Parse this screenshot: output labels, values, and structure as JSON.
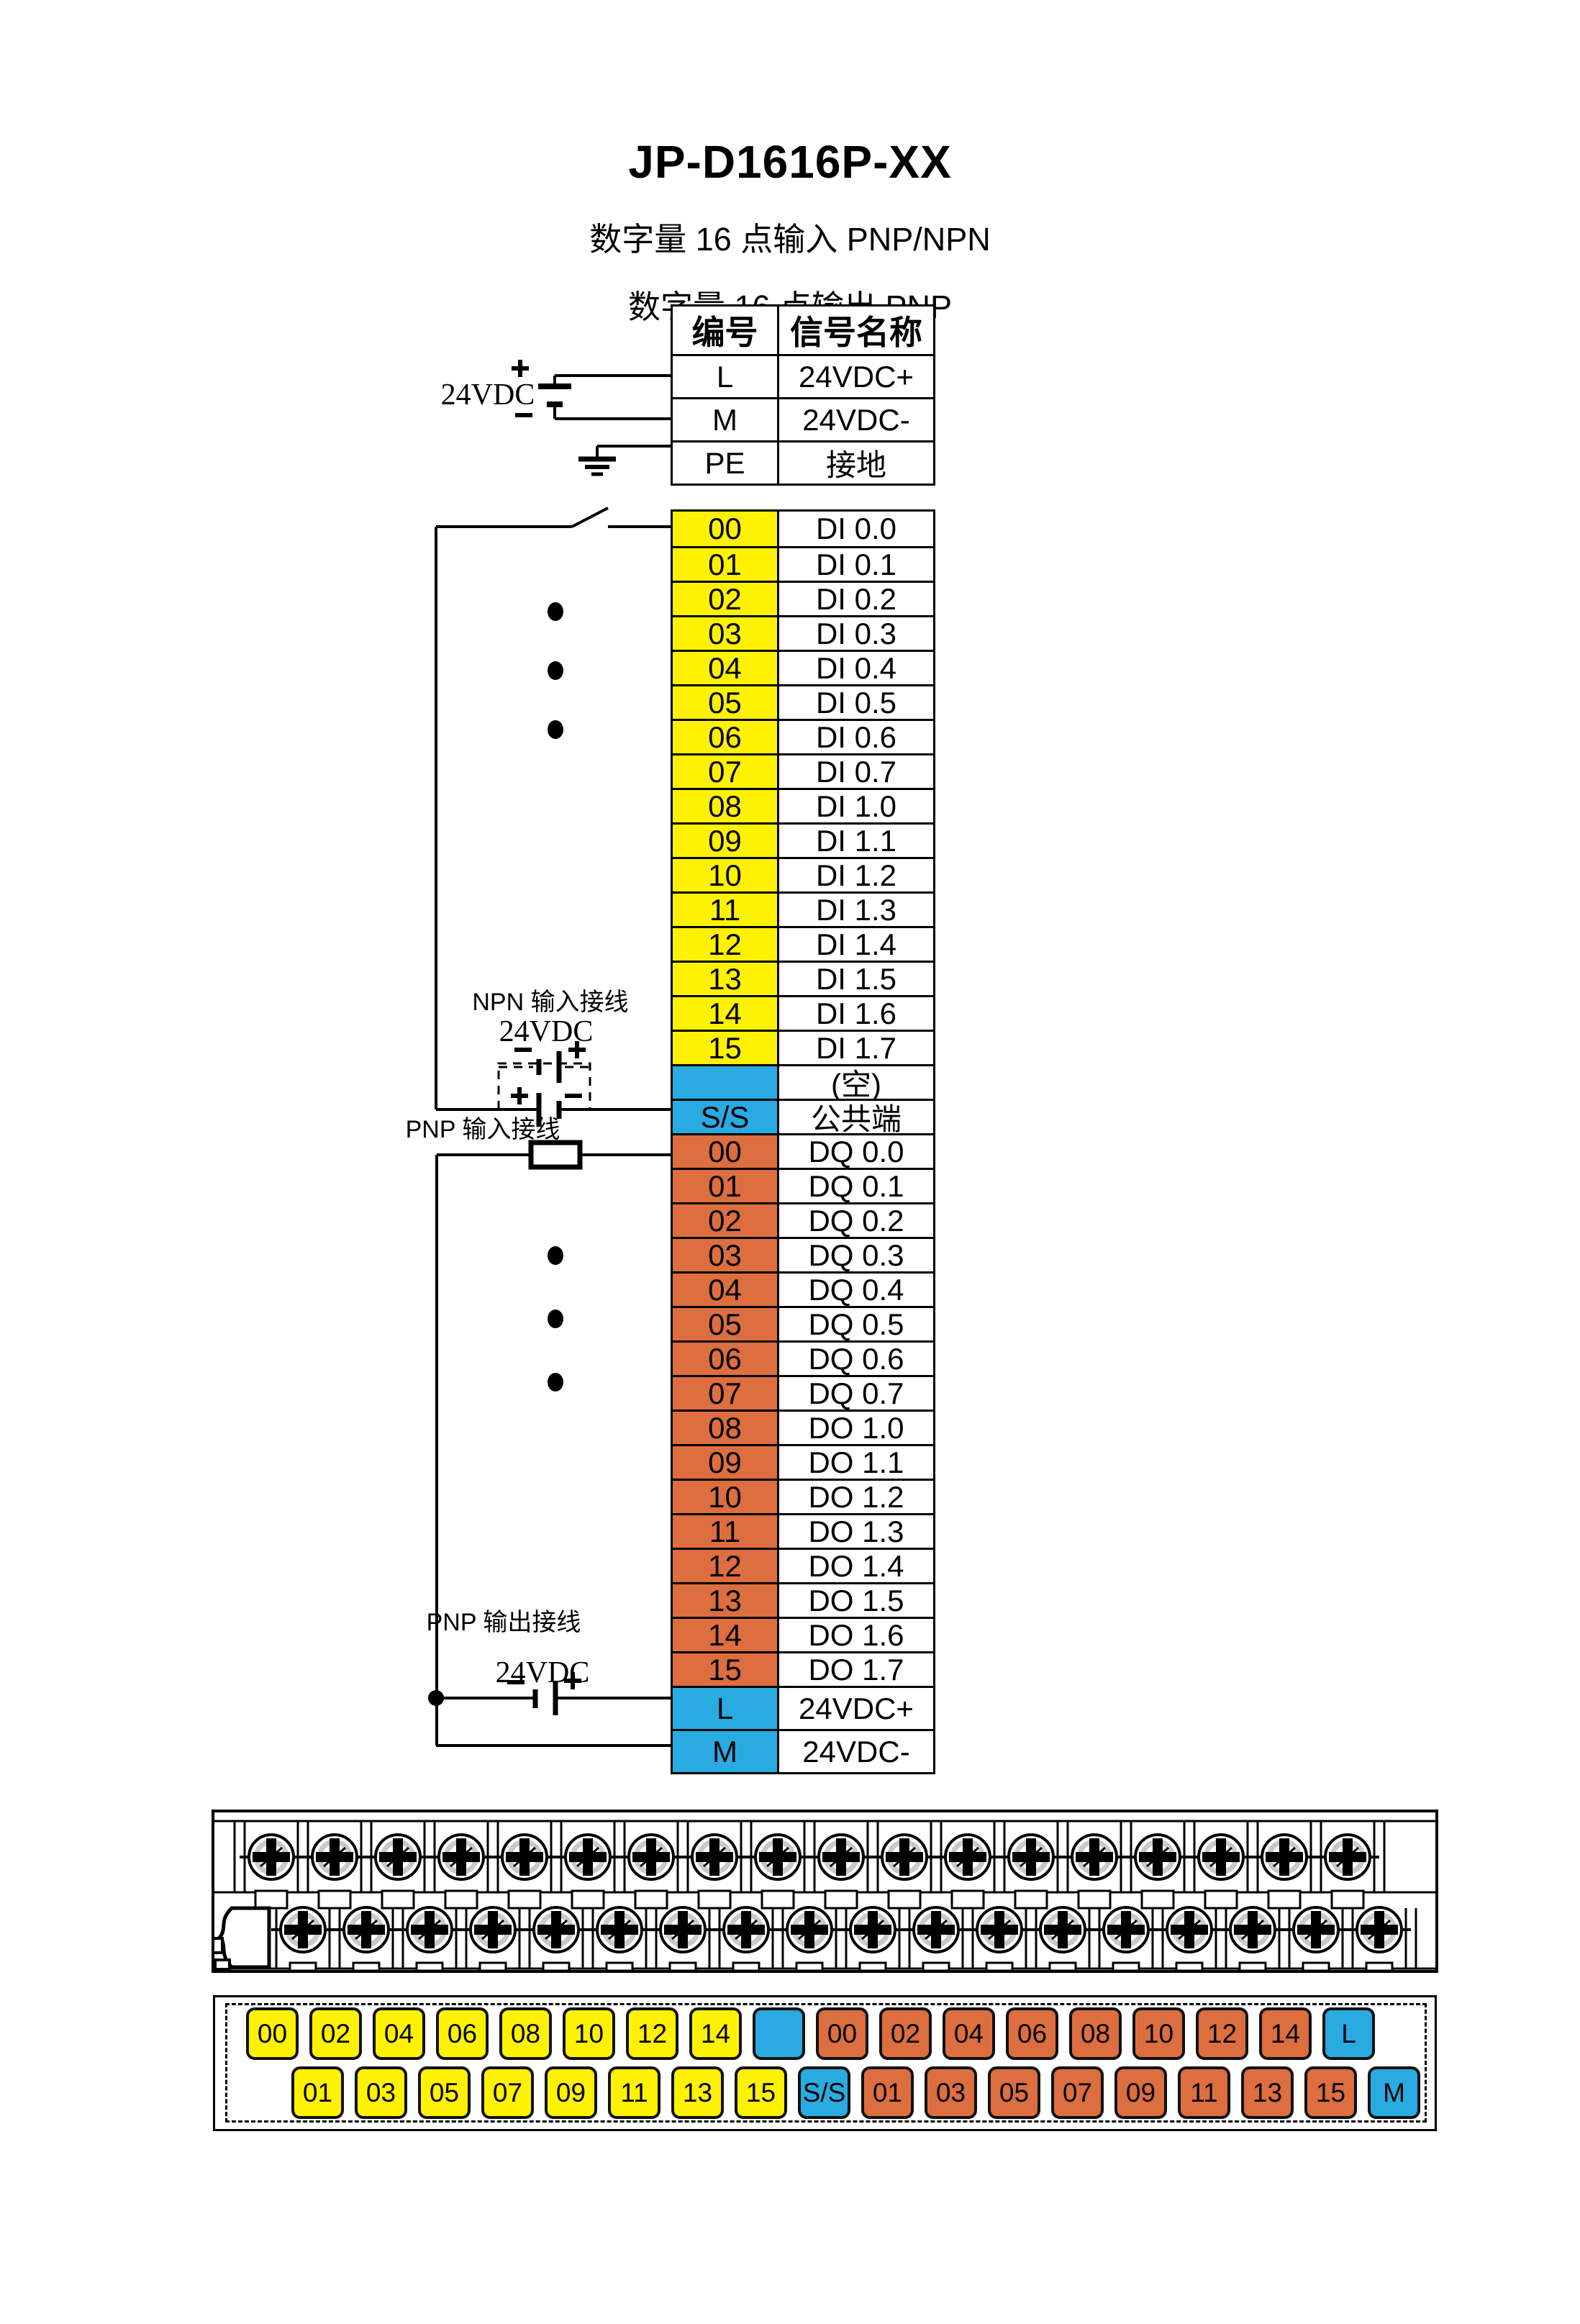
{
  "title": "JP-D1616P-XX",
  "subtitle_input": "数字量 16 点输入  PNP/NPN",
  "subtitle_output": "数字量 16 点输出  PNP",
  "colors": {
    "yellow": "#FFF200",
    "orange": "#DC6E3F",
    "blue": "#29ABE2",
    "white": "#FFFFFF"
  },
  "wiring": {
    "power_label": "24VDC",
    "npn_section_label": "NPN 输入接线",
    "npn_power_label": "24VDC",
    "pnp_input_label": "PNP 输入接线",
    "pnp_output_label": "PNP 输出接线",
    "output_power_label": "24VDC"
  },
  "power_table": {
    "headers": [
      "编号",
      "信号名称"
    ],
    "rows": [
      {
        "no": "L",
        "name": "24VDC+",
        "color": "white"
      },
      {
        "no": "M",
        "name": "24VDC-",
        "color": "white"
      },
      {
        "no": "PE",
        "name": "接地",
        "color": "white"
      }
    ]
  },
  "io_table": {
    "rows": [
      {
        "no": "00",
        "name": "DI 0.0",
        "color": "yellow"
      },
      {
        "no": "01",
        "name": "DI 0.1",
        "color": "yellow"
      },
      {
        "no": "02",
        "name": "DI 0.2",
        "color": "yellow"
      },
      {
        "no": "03",
        "name": "DI 0.3",
        "color": "yellow"
      },
      {
        "no": "04",
        "name": "DI 0.4",
        "color": "yellow"
      },
      {
        "no": "05",
        "name": "DI 0.5",
        "color": "yellow"
      },
      {
        "no": "06",
        "name": "DI 0.6",
        "color": "yellow"
      },
      {
        "no": "07",
        "name": "DI 0.7",
        "color": "yellow"
      },
      {
        "no": "08",
        "name": "DI 1.0",
        "color": "yellow"
      },
      {
        "no": "09",
        "name": "DI 1.1",
        "color": "yellow"
      },
      {
        "no": "10",
        "name": "DI 1.2",
        "color": "yellow"
      },
      {
        "no": "11",
        "name": "DI 1.3",
        "color": "yellow"
      },
      {
        "no": "12",
        "name": "DI 1.4",
        "color": "yellow"
      },
      {
        "no": "13",
        "name": "DI 1.5",
        "color": "yellow"
      },
      {
        "no": "14",
        "name": "DI 1.6",
        "color": "yellow"
      },
      {
        "no": "15",
        "name": "DI 1.7",
        "color": "yellow"
      },
      {
        "no": "",
        "name": "(空)",
        "color": "blue"
      },
      {
        "no": "S/S",
        "name": "公共端",
        "color": "blue"
      },
      {
        "no": "00",
        "name": "DQ 0.0",
        "color": "orange"
      },
      {
        "no": "01",
        "name": "DQ 0.1",
        "color": "orange"
      },
      {
        "no": "02",
        "name": "DQ 0.2",
        "color": "orange"
      },
      {
        "no": "03",
        "name": "DQ 0.3",
        "color": "orange"
      },
      {
        "no": "04",
        "name": "DQ 0.4",
        "color": "orange"
      },
      {
        "no": "05",
        "name": "DQ 0.5",
        "color": "orange"
      },
      {
        "no": "06",
        "name": "DQ 0.6",
        "color": "orange"
      },
      {
        "no": "07",
        "name": "DQ 0.7",
        "color": "orange"
      },
      {
        "no": "08",
        "name": "DO 1.0",
        "color": "orange"
      },
      {
        "no": "09",
        "name": "DO 1.1",
        "color": "orange"
      },
      {
        "no": "10",
        "name": "DO 1.2",
        "color": "orange"
      },
      {
        "no": "11",
        "name": "DO 1.3",
        "color": "orange"
      },
      {
        "no": "12",
        "name": "DO 1.4",
        "color": "orange"
      },
      {
        "no": "13",
        "name": "DO 1.5",
        "color": "orange"
      },
      {
        "no": "14",
        "name": "DO 1.6",
        "color": "orange"
      },
      {
        "no": "15",
        "name": "DO 1.7",
        "color": "orange"
      },
      {
        "no": "L",
        "name": "24VDC+",
        "color": "blue"
      },
      {
        "no": "M",
        "name": "24VDC-",
        "color": "blue"
      }
    ]
  },
  "terminal_labels": {
    "top": [
      {
        "text": "00",
        "color": "yellow"
      },
      {
        "text": "02",
        "color": "yellow"
      },
      {
        "text": "04",
        "color": "yellow"
      },
      {
        "text": "06",
        "color": "yellow"
      },
      {
        "text": "08",
        "color": "yellow"
      },
      {
        "text": "10",
        "color": "yellow"
      },
      {
        "text": "12",
        "color": "yellow"
      },
      {
        "text": "14",
        "color": "yellow"
      },
      {
        "text": "",
        "color": "blue"
      },
      {
        "text": "00",
        "color": "orange"
      },
      {
        "text": "02",
        "color": "orange"
      },
      {
        "text": "04",
        "color": "orange"
      },
      {
        "text": "06",
        "color": "orange"
      },
      {
        "text": "08",
        "color": "orange"
      },
      {
        "text": "10",
        "color": "orange"
      },
      {
        "text": "12",
        "color": "orange"
      },
      {
        "text": "14",
        "color": "orange"
      },
      {
        "text": "L",
        "color": "blue"
      }
    ],
    "bottom": [
      {
        "text": "01",
        "color": "yellow"
      },
      {
        "text": "03",
        "color": "yellow"
      },
      {
        "text": "05",
        "color": "yellow"
      },
      {
        "text": "07",
        "color": "yellow"
      },
      {
        "text": "09",
        "color": "yellow"
      },
      {
        "text": "11",
        "color": "yellow"
      },
      {
        "text": "13",
        "color": "yellow"
      },
      {
        "text": "15",
        "color": "yellow"
      },
      {
        "text": "S/S",
        "color": "blue"
      },
      {
        "text": "01",
        "color": "orange"
      },
      {
        "text": "03",
        "color": "orange"
      },
      {
        "text": "05",
        "color": "orange"
      },
      {
        "text": "07",
        "color": "orange"
      },
      {
        "text": "09",
        "color": "orange"
      },
      {
        "text": "11",
        "color": "orange"
      },
      {
        "text": "13",
        "color": "orange"
      },
      {
        "text": "15",
        "color": "orange"
      },
      {
        "text": "M",
        "color": "blue"
      }
    ]
  }
}
